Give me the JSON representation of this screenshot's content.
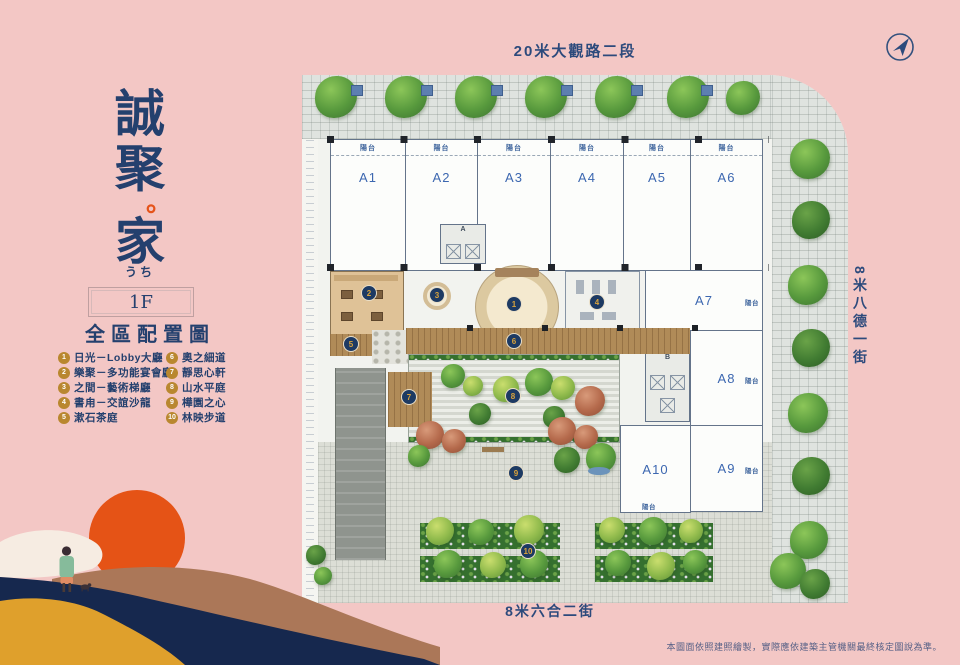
{
  "brand": {
    "title_char_1": "誠",
    "title_char_2": "聚",
    "title_dot": "。",
    "title_char_3": "家",
    "subtitle": "うち",
    "floor_label": "1F",
    "section_title": "全區配置圖"
  },
  "legend": {
    "col1": [
      {
        "num": "1",
        "label": "日光－Lobby大廳"
      },
      {
        "num": "2",
        "label": "樂聚－多功能宴會廳"
      },
      {
        "num": "3",
        "label": "之間－藝術梯廳"
      },
      {
        "num": "4",
        "label": "書甪－交誼沙龍"
      },
      {
        "num": "5",
        "label": "漱石茶庭"
      }
    ],
    "col2": [
      {
        "num": "6",
        "label": "奧之細道"
      },
      {
        "num": "7",
        "label": "靜思心軒"
      },
      {
        "num": "8",
        "label": "山水平庭"
      },
      {
        "num": "9",
        "label": "樺園之心"
      },
      {
        "num": "10",
        "label": "林映步道"
      }
    ]
  },
  "streets": {
    "top": "20米大觀路二段",
    "right": "8米八德一街",
    "bottom": "8米六合二街"
  },
  "plan": {
    "balcony_label": "陽台",
    "unit_labels": [
      "A1",
      "A2",
      "A3",
      "A4",
      "A5",
      "A6",
      "A7",
      "A8",
      "A9",
      "A10"
    ],
    "core_labels": [
      "A",
      "B"
    ],
    "markers": [
      "1",
      "2",
      "3",
      "4",
      "5",
      "6",
      "7",
      "8",
      "9",
      "10"
    ]
  },
  "disclaimer": "本圖面依照建照繪製，實際應依建築主管機關最終核定圖說為準。",
  "colors": {
    "background": "#f3c7c5",
    "navy": "#24406e",
    "orange": "#e5531a",
    "gold": "#b9872f",
    "unit_blue": "#3c67b0",
    "wood": "#b08b58"
  }
}
